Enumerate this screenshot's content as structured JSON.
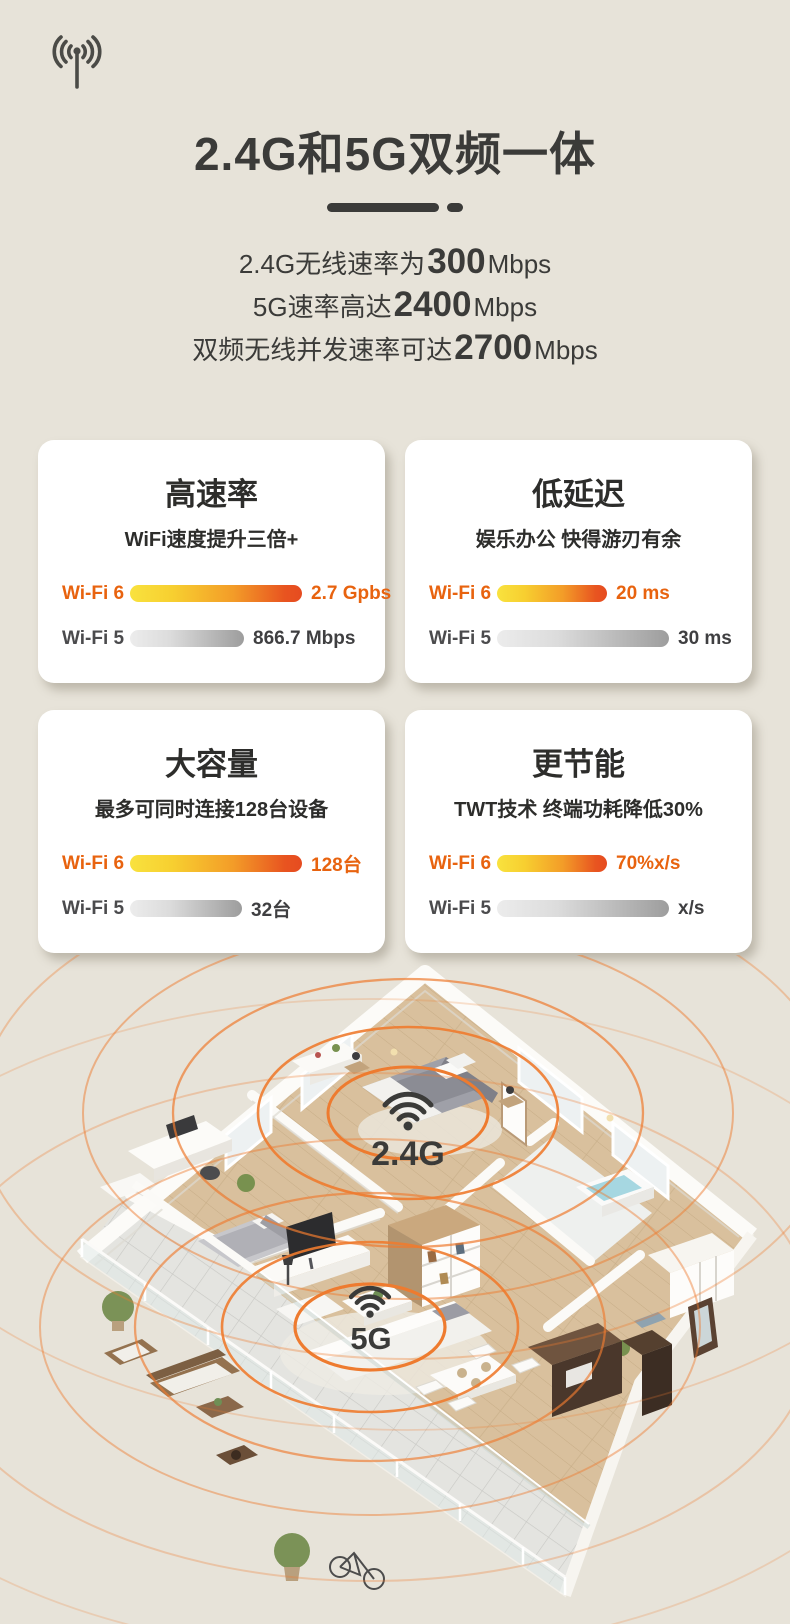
{
  "colors": {
    "page_bg": "#e7e3d9",
    "text_dark": "#3b3b39",
    "accent_orange": "#e8630f",
    "ripple_orange": "#ee7b2f",
    "card_bg": "#ffffff",
    "wifi5_gray": "#4b4b4d"
  },
  "header": {
    "antenna_icon": "antenna-signal-icon",
    "title": "2.4G和5G双频一体"
  },
  "specs": [
    {
      "prefix": "2.4G无线速率为",
      "value": "300",
      "suffix": "Mbps"
    },
    {
      "prefix": "5G速率高达",
      "value": "2400",
      "suffix": "Mbps"
    },
    {
      "prefix": "双频无线并发速率可达",
      "value": "2700",
      "suffix": "Mbps"
    }
  ],
  "cards": [
    {
      "title": "高速率",
      "subtitle": "WiFi速度提升三倍+",
      "rows": [
        {
          "label": "Wi-Fi 6",
          "value": "2.7 Gpbs",
          "bar_percent": 100
        },
        {
          "label": "Wi-Fi 5",
          "value": "866.7 Mbps",
          "bar_percent": 66
        }
      ]
    },
    {
      "title": "低延迟",
      "subtitle": "娱乐办公 快得游刃有余",
      "rows": [
        {
          "label": "Wi-Fi 6",
          "value": "20 ms",
          "bar_percent": 64
        },
        {
          "label": "Wi-Fi 5",
          "value": "30 ms",
          "bar_percent": 100
        }
      ]
    },
    {
      "title": "大容量",
      "subtitle": "最多可同时连接128台设备",
      "rows": [
        {
          "label": "Wi-Fi 6",
          "value": "128台",
          "bar_percent": 100
        },
        {
          "label": "Wi-Fi 5",
          "value": "32台",
          "bar_percent": 65
        }
      ]
    },
    {
      "title": "更节能",
      "subtitle": "TWT技术 终端功耗降低30%",
      "rows": [
        {
          "label": "Wi-Fi 6",
          "value": "70%x/s",
          "bar_percent": 64
        },
        {
          "label": "Wi-Fi 5",
          "value": "x/s",
          "bar_percent": 100
        }
      ]
    }
  ],
  "floorplan": {
    "labels": [
      {
        "text": "2.4G"
      },
      {
        "text": "5G"
      }
    ]
  }
}
